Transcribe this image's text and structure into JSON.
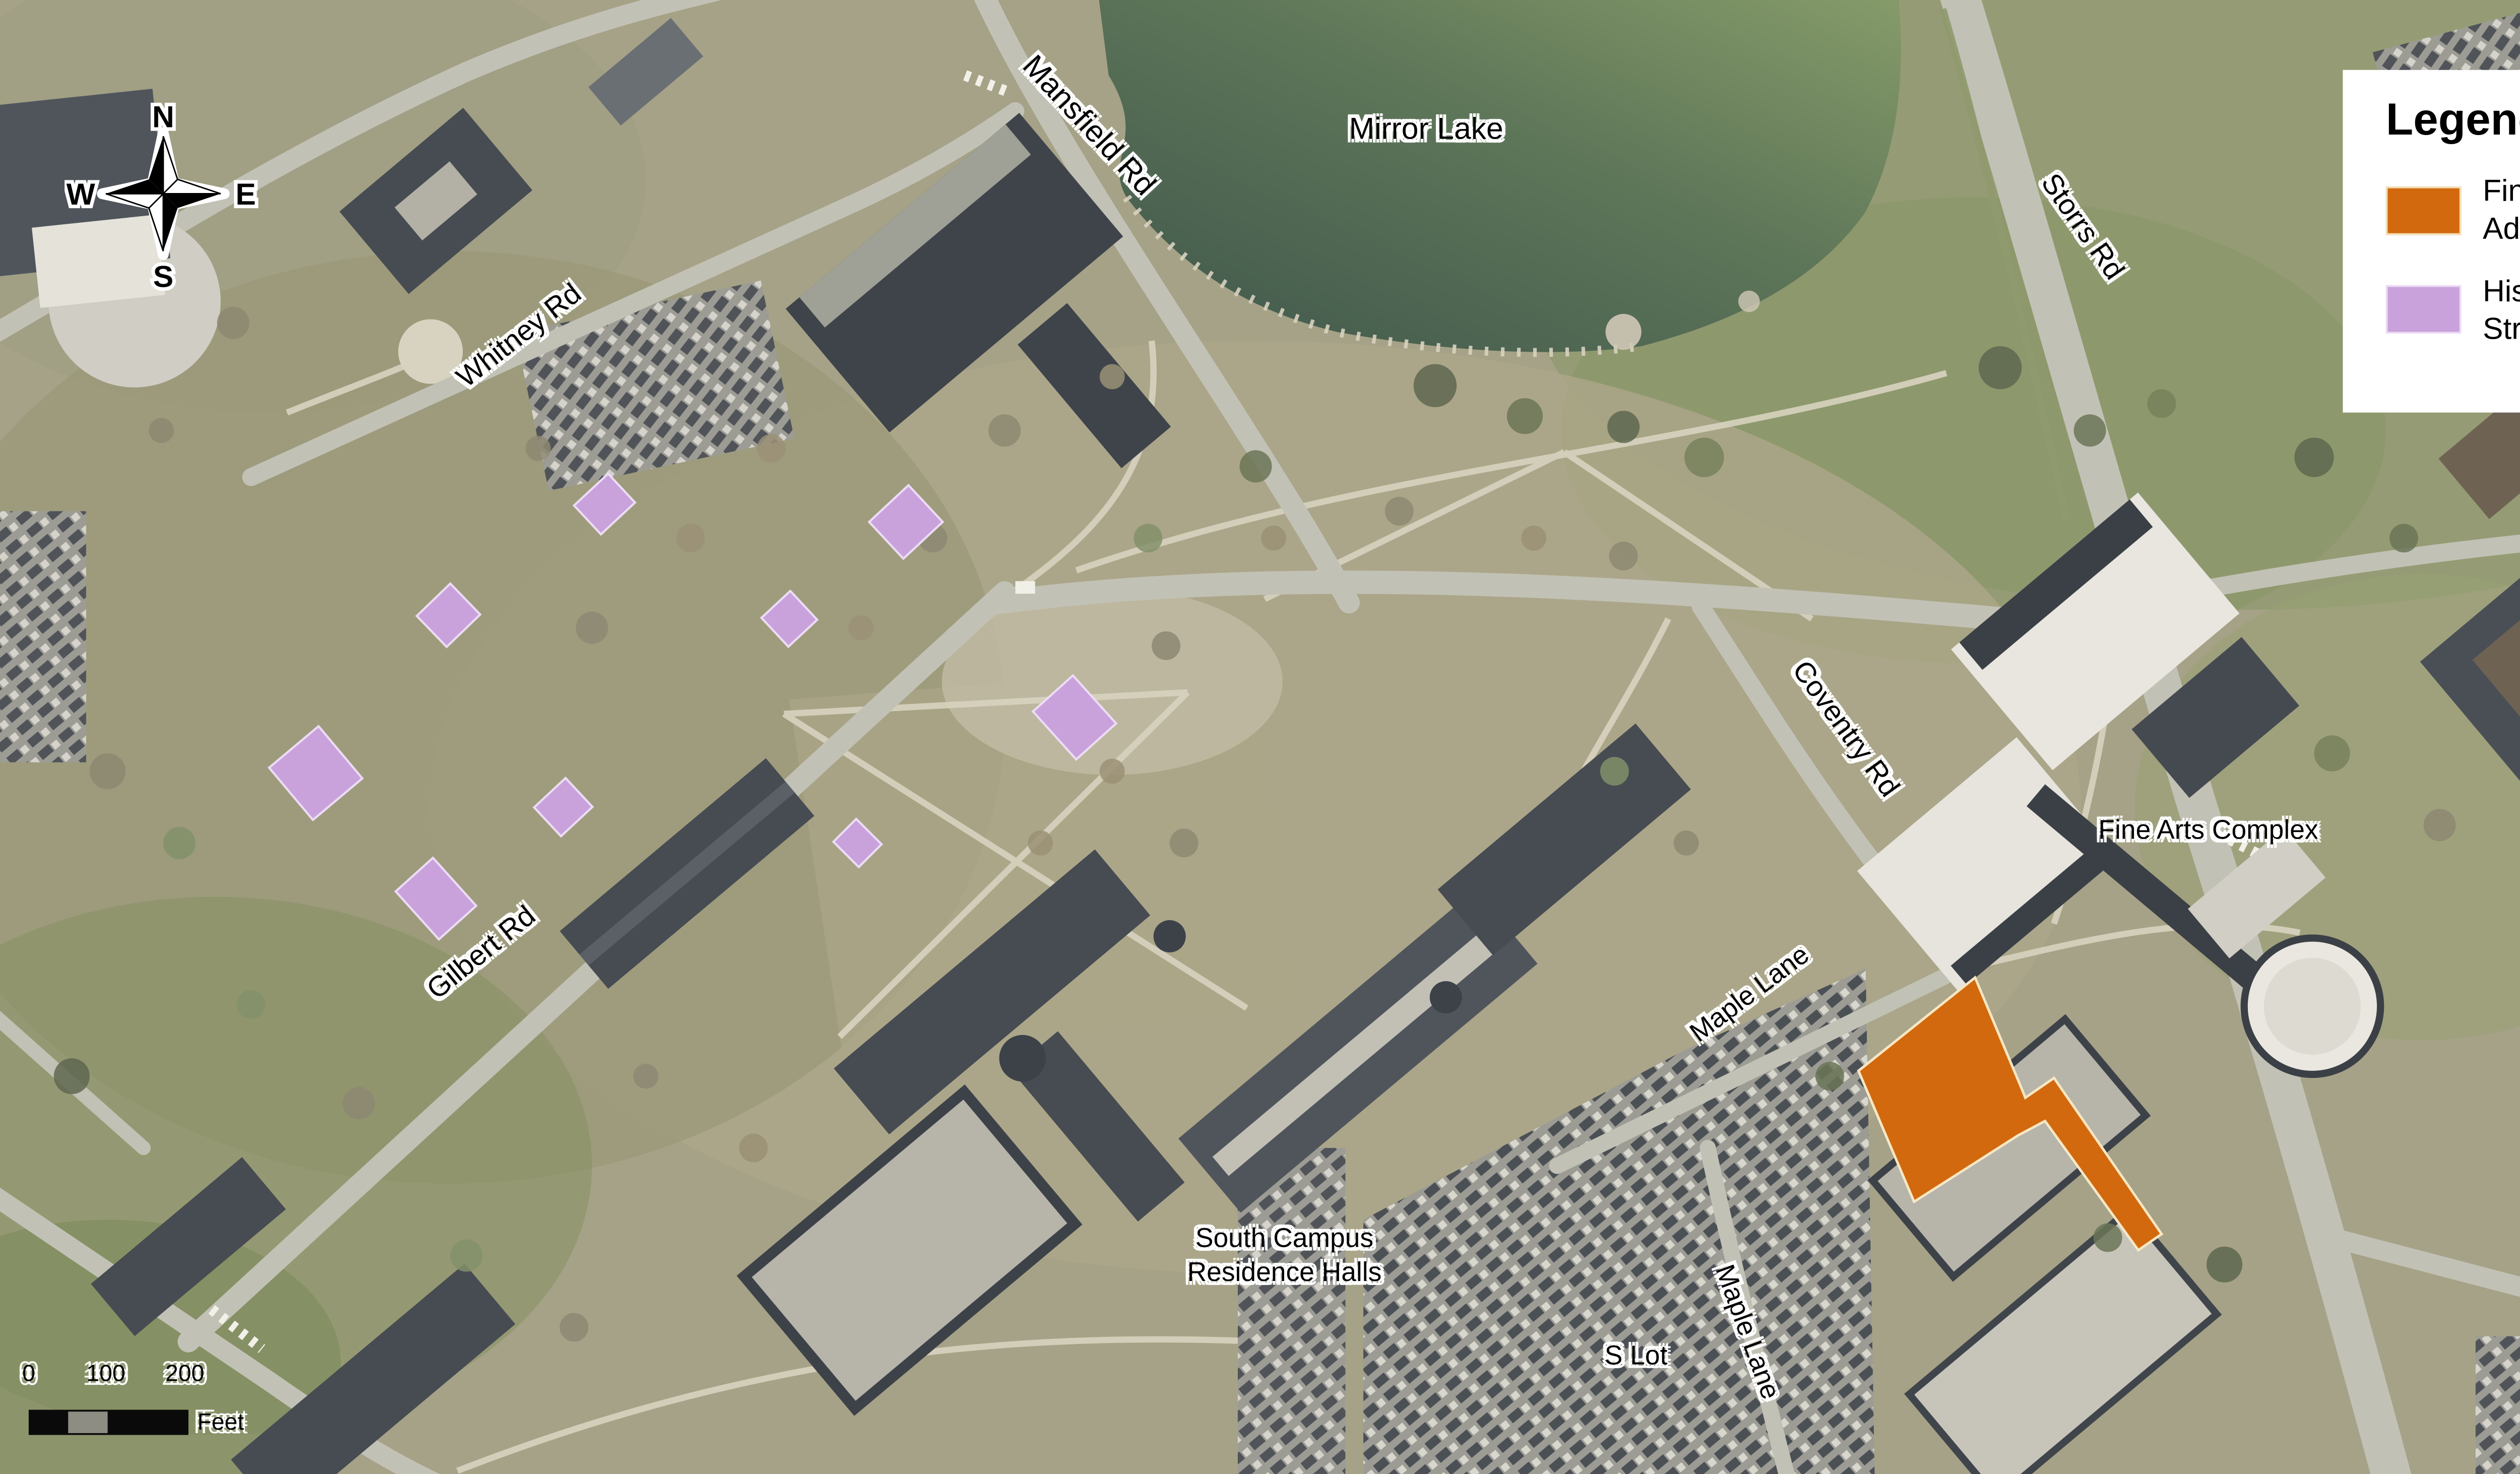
{
  "legend": {
    "title": "Legend",
    "items": [
      {
        "label": "Fine Arts Addition",
        "color": "#D2690E"
      },
      {
        "label": "Historic Structures",
        "color": "#C9A2DC"
      }
    ]
  },
  "compass": {
    "n": "N",
    "e": "E",
    "s": "S",
    "w": "W"
  },
  "scale_bar": {
    "ticks": [
      "0",
      "100",
      "200"
    ],
    "unit": "Feet"
  },
  "map_labels": {
    "mirror_lake": "Mirror Lake",
    "mansfield_rd": "Mansfield Rd",
    "whitney_rd": "Whitney Rd",
    "storrs_rd": "Storrs Rd",
    "coventry_rd": "Coventry Rd",
    "fine_arts_complex": "Fine Arts Complex",
    "gilbert_rd": "Gilbert Rd",
    "maple_lane_upper": "Maple Lane",
    "maple_lane_lower": "Maple Lane",
    "south_campus_line1": "South Campus",
    "south_campus_line2": "Residence Halls",
    "s_lot": "S Lot",
    "route_195": "Route 195"
  }
}
